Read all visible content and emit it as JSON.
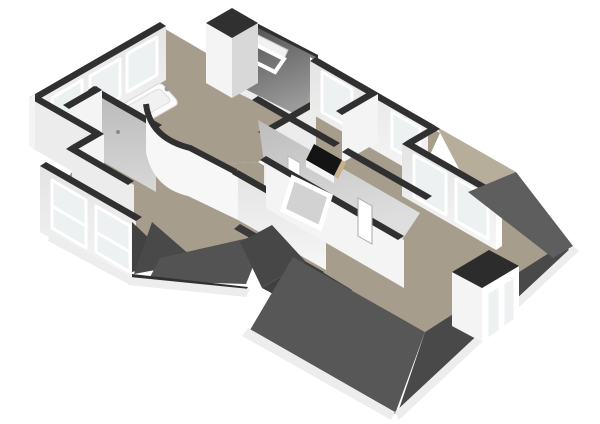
{
  "scene": {
    "description": "3D isometric top-down rendering of an upper-storey floor plan with white walls, taupe floors and dark grey roof slopes on a white background",
    "view": "axonometric-from-south",
    "visible_text": "none"
  },
  "palette": {
    "background": "#ffffff",
    "floor": "#a69d8c",
    "floor_light": "#b6ad9b",
    "wall_top": "#303030",
    "wall_white": "#f4f4f4",
    "wall_light": "#ececec",
    "wall_shaded": "#d8d8d8",
    "wall_gray": "#c6c6c6",
    "slope_interior": "#c8c8c8",
    "roof_deep": "#3a3a3a",
    "roof_dark": "#494949",
    "roof_mid": "#575757",
    "roof_soft": "#5e5e5e",
    "glass": "#edf1f2",
    "frame_white": "#ffffff",
    "stair_void": "#141414",
    "wood": "#c8b089",
    "fascia": "#ededed"
  },
  "fixtures": {
    "bathtub_count": 1,
    "bath_faucet_count": 1,
    "chimney_shaft_count": 1,
    "stair_opening_count": 1,
    "roof_window_count": 2,
    "dormer_count": 1,
    "dormer_pane_count": 2,
    "nw_facade_window_count": 3,
    "sw_facade_window_count": 2,
    "ne_facade_window_count": 2,
    "master_window_count": 2,
    "interior_door_count": 2
  }
}
